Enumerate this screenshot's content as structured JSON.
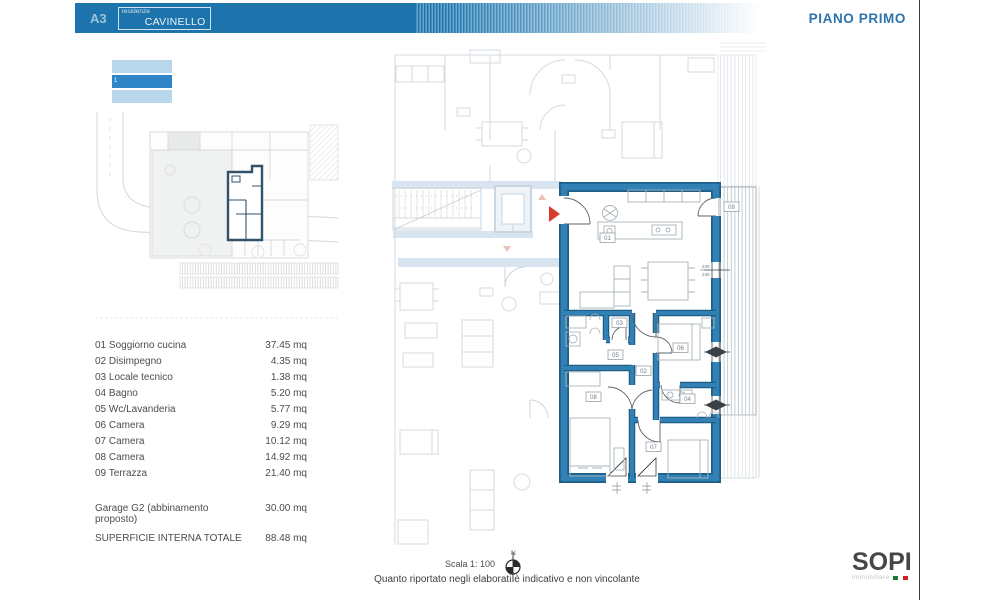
{
  "header": {
    "sheet_code": "A3",
    "residence_label": "residenze",
    "residence_name": "CAVINELLO",
    "floor_title": "PIANO PRIMO"
  },
  "floor_indicator": {
    "selected_label": "1"
  },
  "legend": {
    "rooms": [
      {
        "label": "01 Soggiorno cucina",
        "area": "37.45 mq"
      },
      {
        "label": "02 Disimpegno",
        "area": "4.35 mq"
      },
      {
        "label": "03 Locale tecnico",
        "area": "1.38 mq"
      },
      {
        "label": "04 Bagno",
        "area": "5.20 mq"
      },
      {
        "label": "05 Wc/Lavanderia",
        "area": "5.77 mq"
      },
      {
        "label": "06 Camera",
        "area": "9.29 mq"
      },
      {
        "label": "07 Camera",
        "area": "10.12 mq"
      },
      {
        "label": "08 Camera",
        "area": "14.92 mq"
      },
      {
        "label": "09 Terrazza",
        "area": "21.40 mq"
      }
    ],
    "garage": {
      "label": "Garage G2 (abbinamento proposto)",
      "area": "30.00 mq"
    },
    "total": {
      "label": "SUPERFICIE INTERNA TOTALE",
      "area": "88.48 mq"
    }
  },
  "plan": {
    "labels": {
      "r01": "01",
      "r02": "02",
      "r03": "03",
      "r04": "04",
      "r05": "05",
      "r06": "06",
      "r07": "07",
      "r08": "08",
      "r09": "09"
    },
    "dims": {
      "d1": "240",
      "d2": "240"
    }
  },
  "footer": {
    "scale": "Scala 1: 100",
    "compass_n": "N",
    "disclaimer": "Quanto riportato negli elaborati è indicativo e non vincolante"
  },
  "logo": {
    "name": "SOPI",
    "tagline": "immobiliare"
  },
  "colors": {
    "accent_blue": "#1d73ac",
    "wall_blue": "#3181b5",
    "wall_dark": "#1e5e87",
    "entry_red": "#d93a2b",
    "logo_green": "#1e7a3c",
    "logo_red": "#cc2127"
  }
}
